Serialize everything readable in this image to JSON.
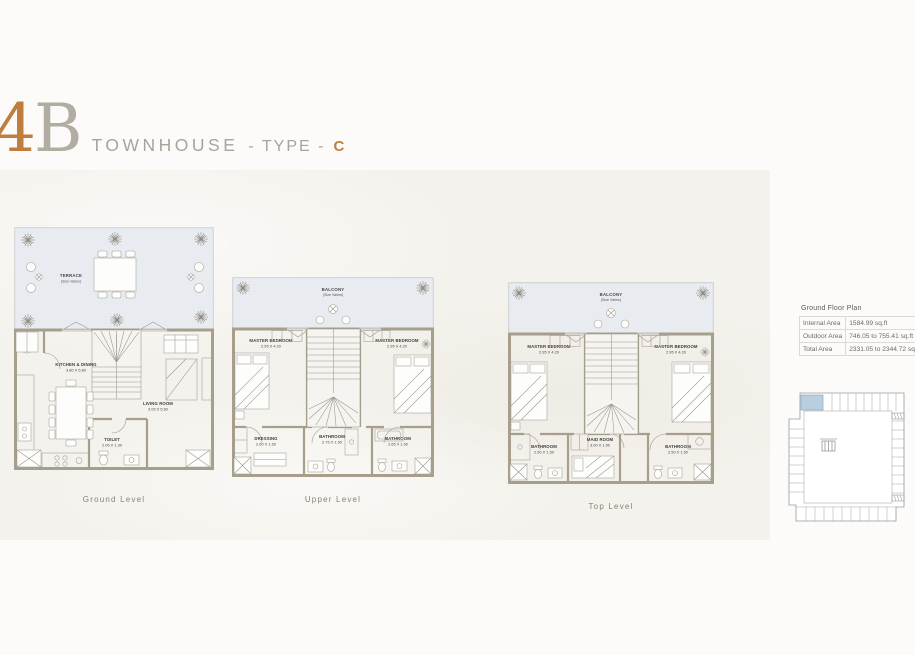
{
  "title": {
    "digit": "4",
    "letter": "B",
    "word": "TOWNHOUSE",
    "sep": "- TYPE -",
    "type": "C"
  },
  "colors": {
    "accent": "#bd7e3e",
    "muted_letter": "#b2aca2",
    "word_gray": "#a9a39a",
    "wall": "#a79e8c",
    "outdoor_fill": "#e8ecf1",
    "highlight_unit": "#b9cfe0"
  },
  "plans": [
    {
      "caption": "Ground Level",
      "outdoor": {
        "name": "TERRACE",
        "note": "(Size Varies)"
      },
      "rooms": [
        {
          "name": "KITCHEN & DINING",
          "dims": "3.80 X 5.80"
        },
        {
          "name": "LIVING ROOM",
          "dims": "3.05 X 5.60"
        },
        {
          "name": "TOILET",
          "dims": "2.05 X 1.30"
        }
      ]
    },
    {
      "caption": "Upper Level",
      "outdoor": {
        "name": "BALCONY",
        "note": "(Size Varies)"
      },
      "rooms": [
        {
          "name": "MASTER BEDROOM",
          "dims": "2.95 X 4.20"
        },
        {
          "name": "MASTER BEDROOM",
          "dims": "2.95 X 4.20"
        },
        {
          "name": "DRESSING",
          "dims": "2.60 X 1.50"
        },
        {
          "name": "BATHROOM",
          "dims": "2.75 X 1.50"
        },
        {
          "name": "BATHROOM",
          "dims": "2.65 X 1.50"
        }
      ]
    },
    {
      "caption": "Top Level",
      "outdoor": {
        "name": "BALCONY",
        "note": "(Size Varies)"
      },
      "rooms": [
        {
          "name": "MASTER BEDROOM",
          "dims": "2.95 X 4.20"
        },
        {
          "name": "MASTER BEDROOM",
          "dims": "2.95 X 4.20"
        },
        {
          "name": "BATHROOM",
          "dims": "2.50 X 1.50"
        },
        {
          "name": "MAID ROOM",
          "dims": "3.00 X 1.50"
        },
        {
          "name": "BATHROOM",
          "dims": "2.50 X 1.50"
        }
      ]
    }
  ],
  "area_table": {
    "title": "Ground Floor Plan",
    "rows": [
      {
        "label": "Internal Area",
        "value": "1584.99 sq.ft"
      },
      {
        "label": "Outdoor Area",
        "value": "746.05 to 755.41 sq.ft"
      },
      {
        "label": "Total Area",
        "value": "2331.05 to 2344.72 sq.ft"
      }
    ]
  }
}
